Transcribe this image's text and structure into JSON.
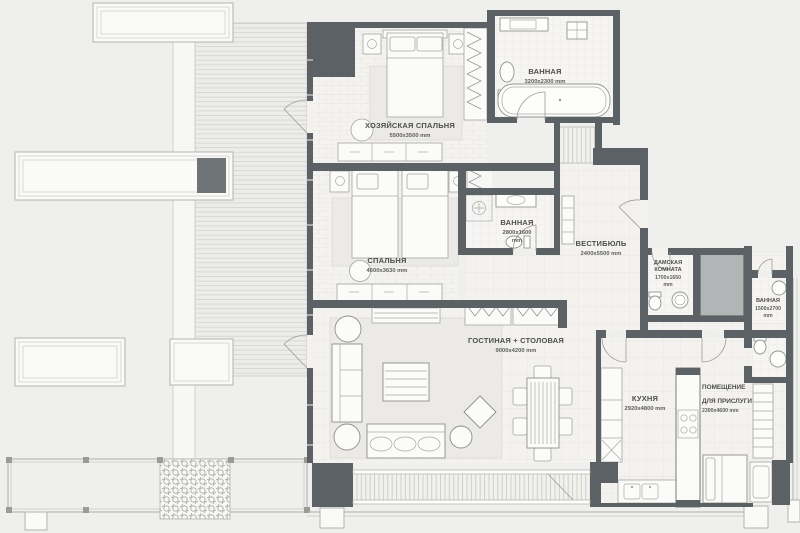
{
  "plan": {
    "type": "apartment-floor-plan",
    "unit": "mm",
    "rooms": [
      {
        "id": "master-bedroom",
        "name": "ХОЗЯЙСКАЯ СПАЛЬНЯ",
        "size": "5500x3500 mm"
      },
      {
        "id": "bathroom-1",
        "name": "ВАННАЯ",
        "size": "3200x2300 mm"
      },
      {
        "id": "bedroom",
        "name": "СПАЛЬНЯ",
        "size": "4600x3630 mm"
      },
      {
        "id": "bathroom-2",
        "name": "ВАННАЯ",
        "size": "2800x1600",
        "size_unit": "mm"
      },
      {
        "id": "vestibule",
        "name": "ВЕСТИБЮЛЬ",
        "size": "2400x5500 mm"
      },
      {
        "id": "powder-room",
        "name_line1": "ДАМСКАЯ",
        "name_line2": "КОМНАТА",
        "size": "1700x1650",
        "size_unit": "mm"
      },
      {
        "id": "bathroom-3",
        "name": "ВАННАЯ",
        "size": "1500x2700",
        "size_unit": "mm"
      },
      {
        "id": "living-dining",
        "name": "ГОСТИНАЯ + СТОЛОВАЯ",
        "size": "9000x4200 mm"
      },
      {
        "id": "kitchen",
        "name": "КУХНЯ",
        "size": "2920x4800 mm"
      },
      {
        "id": "staff-room",
        "name_line1": "ПОМЕЩЕНИЕ",
        "name_line2": "ДЛЯ ПРИСЛУГИ",
        "size": "2300x4600 mm"
      }
    ],
    "colors": {
      "wall": "#5c6165",
      "floor": "#f3f2ef",
      "background": "#efefed",
      "shaft": "#b2b5b6",
      "dark_panel": "#6f7477"
    }
  }
}
